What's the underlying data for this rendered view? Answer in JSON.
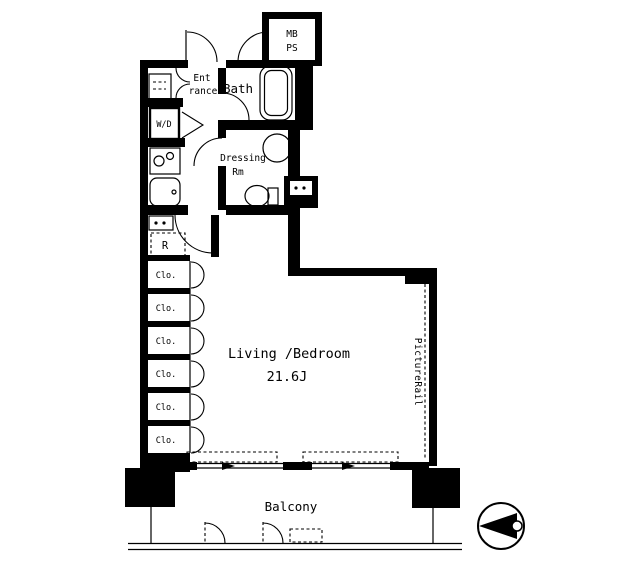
{
  "floorplan": {
    "title": "apartment-floor-plan",
    "colors": {
      "ink": "#000000",
      "background": "#ffffff"
    },
    "mb_ps": {
      "line1": "MB",
      "line2": "PS"
    },
    "entrance": {
      "line1": "Ent",
      "line2": "rance"
    },
    "bath": {
      "label": "Bath"
    },
    "dressing": {
      "line1": "Dressing",
      "line2": "Rm"
    },
    "washer_dryer": {
      "label": "W/D"
    },
    "refrigerator": {
      "label": "R"
    },
    "closets": [
      {
        "label": "Clo."
      },
      {
        "label": "Clo."
      },
      {
        "label": "Clo."
      },
      {
        "label": "Clo."
      },
      {
        "label": "Clo."
      },
      {
        "label": "Clo."
      }
    ],
    "living": {
      "name": "Living /Bedroom",
      "size": "21.6J"
    },
    "picture_rail": {
      "label": "PictureRail"
    },
    "balcony": {
      "label": "Balcony"
    },
    "icons": {
      "compass": "north-arrow-pointing-left"
    }
  }
}
